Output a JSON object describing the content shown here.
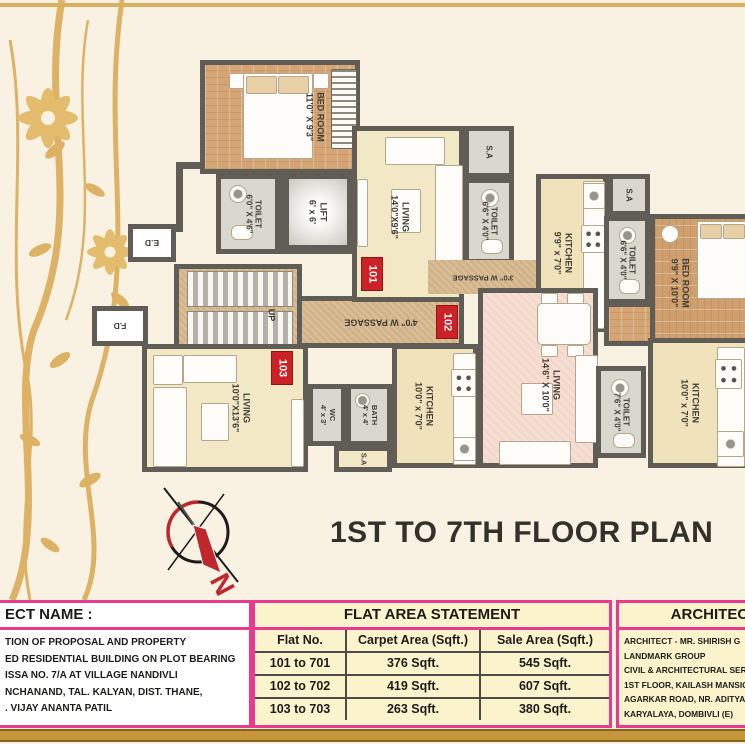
{
  "title": "1ST TO 7TH FLOOR PLAN",
  "plan": {
    "badges": {
      "u101": "101",
      "u102": "102",
      "u103": "103"
    },
    "labels": {
      "sa": "S.A",
      "up": "UP",
      "ed": "E.D",
      "fd": "F.D",
      "north": "N"
    },
    "passages": {
      "p3": "3'0\" W PASSAGE",
      "p4": "4'0\" W PASSAGE"
    },
    "rooms": {
      "bedroom_tl": {
        "name": "BED ROOM",
        "dims": "11'0\" X 9'3\""
      },
      "toilet_tl": {
        "name": "TOILET",
        "dims": "6'0\" X 4'6\""
      },
      "lift": {
        "name": "LIFT",
        "dims": "6' x 6'"
      },
      "living_101": {
        "name": "LIVING",
        "dims": "14'0\"X9'6\""
      },
      "toilet_mid": {
        "name": "TOILET",
        "dims": "6'6\" X 4'0\""
      },
      "kitchen_101": {
        "name": "KITCHEN",
        "dims": "9'9\" x 7'0\""
      },
      "toilet_right": {
        "name": "TOILET",
        "dims": "6'6\" X 4'0\""
      },
      "bedroom_right": {
        "name": "BED ROOM",
        "dims": "9'9\" X 10'0\""
      },
      "living_103": {
        "name": "LIVING",
        "dims": "10'0\"X13'6\""
      },
      "wc_103": {
        "name": "WC",
        "dims": "4' x 3'"
      },
      "bath_103": {
        "name": "BATH",
        "dims": "4' x 4'"
      },
      "kitchen_102": {
        "name": "KITCHEN",
        "dims": "10'0\" x 7'0\""
      },
      "living_102": {
        "name": "LIVING",
        "dims": "14'6\" X 10'0\""
      },
      "toilet_102b": {
        "name": "TOILET",
        "dims": "7'6\" X 4'0\""
      },
      "kitchen_right": {
        "name": "KITCHEN",
        "dims": "10'0\" x 7'0\""
      }
    }
  },
  "footer": {
    "project": {
      "header": "ECT NAME :",
      "lines": [
        "TION OF PROPOSAL AND PROPERTY",
        "ED RESIDENTIAL BUILDING ON PLOT BEARING",
        "ISSA NO. 7/A AT VILLAGE NANDIVLI",
        "NCHANAND, TAL. KALYAN, DIST. THANE,",
        ". VIJAY ANANTA PATIL"
      ]
    },
    "flat_table": {
      "header": "FLAT AREA STATEMENT",
      "columns": [
        "Flat No.",
        "Carpet Area (Sqft.)",
        "Sale Area (Sqft.)"
      ],
      "rows": [
        [
          "101 to 701",
          "376 Sqft.",
          "545 Sqft."
        ],
        [
          "102 to 702",
          "419 Sqft.",
          "607 Sqft."
        ],
        [
          "103 to 703",
          "263 Sqft.",
          "380 Sqft."
        ]
      ]
    },
    "architect": {
      "header": "ARCHITECT",
      "lines": [
        "ARCHITECT - MR. SHIRISH G",
        "LANDMARK GROUP",
        "CIVIL & ARCHITECTURAL SERVIC",
        "1ST FLOOR, KAILASH MANSION,",
        "AGARKAR ROAD, NR. ADITYA MA",
        "KARYALAYA, DOMBIVLI (E)"
      ]
    }
  },
  "colors": {
    "accent_magenta": "#e83a8e",
    "badge_red": "#cc2127",
    "gold": "#d8b160",
    "wall_gray": "#5f5d56",
    "table_bg": "#faf3cb"
  }
}
